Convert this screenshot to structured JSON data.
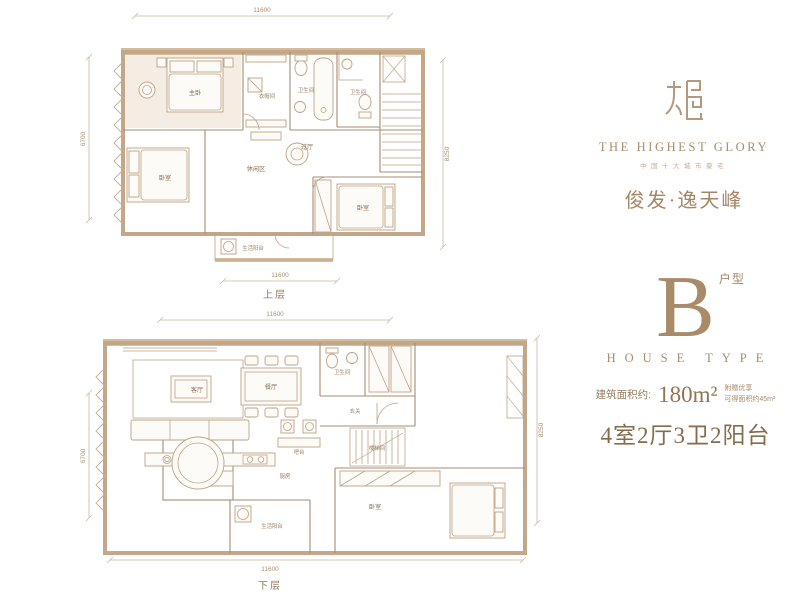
{
  "brand": {
    "name_en": "THE HIGHEST GLORY",
    "tagline": "中国十大城市豪宅",
    "name_cn": "俊发·逸天峰"
  },
  "house_type": {
    "letter": "B",
    "letter_label": "户型",
    "words": "HOUSE TYPE",
    "area_prefix": "建筑面积约:",
    "area_value": "180m²",
    "bonus_line1": "附赠优享",
    "bonus_line2": "可得面积约45m²",
    "summary": "4室2厅3卫2阳台"
  },
  "upper_plan": {
    "caption": "上层",
    "dims": {
      "top": "11600",
      "bottom": "11600",
      "left": "6700",
      "right": "8250"
    },
    "rooms": {
      "master": "主卧",
      "closet": "衣帽间",
      "bath1": "卫生间",
      "bath2": "卫生间",
      "hall": "过厅",
      "leisure": "休闲区",
      "bedroom_left": "卧室",
      "bedroom_right": "卧室",
      "balcony": "生活阳台"
    }
  },
  "lower_plan": {
    "caption": "下层",
    "dims": {
      "top": "11600",
      "bottom": "11600",
      "left": "6700",
      "right": "8250"
    },
    "rooms": {
      "living": "客厅",
      "dining": "餐厅",
      "bath": "卫生间",
      "entry": "玄关",
      "bar": "吧台",
      "kitchen": "厨房",
      "stairwell": "楼梯间",
      "bedroom": "卧室",
      "balcony": "生活阳台"
    }
  }
}
